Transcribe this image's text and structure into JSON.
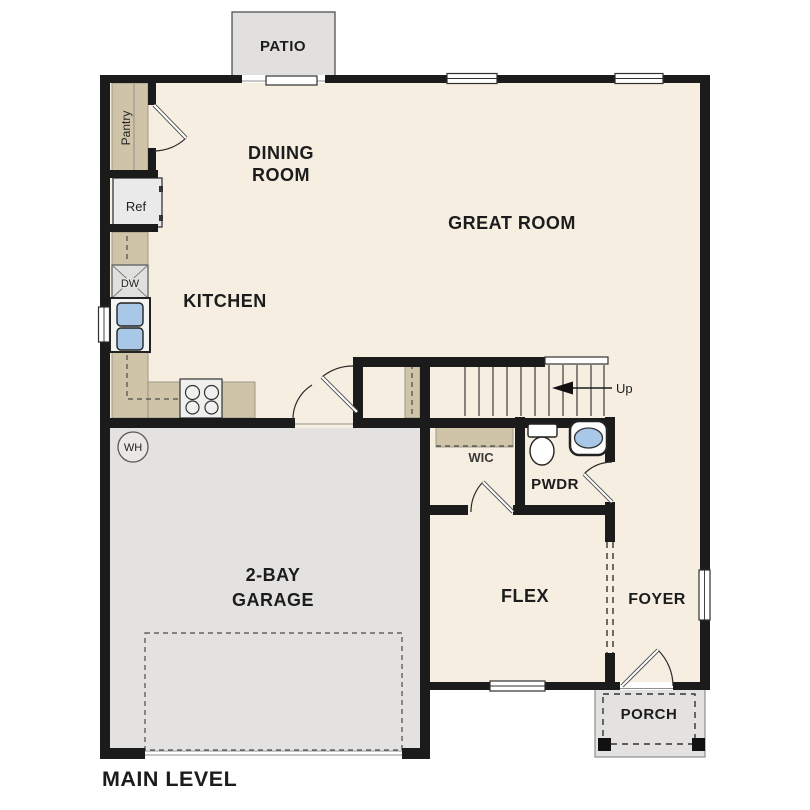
{
  "plan": {
    "title": "MAIN LEVEL",
    "labels": {
      "patio": "PATIO",
      "dining_line1": "DINING",
      "dining_line2": "ROOM",
      "great_room": "GREAT ROOM",
      "kitchen": "KITCHEN",
      "garage_line1": "2-BAY",
      "garage_line2": "GARAGE",
      "wic": "WIC",
      "pwdr": "PWDR",
      "flex": "FLEX",
      "foyer": "FOYER",
      "porch": "PORCH"
    },
    "fixtures": {
      "pantry": "Pantry",
      "ref": "Ref",
      "dw": "DW",
      "wh": "WH",
      "up": "Up"
    },
    "colors": {
      "floor": "#f6eee1",
      "counter": "#d0c4a8",
      "concrete": "#e3e2e0",
      "patio": "#e1e0de",
      "wall": "#1b1b1b",
      "sink_blue": "#a9c7e6"
    }
  }
}
